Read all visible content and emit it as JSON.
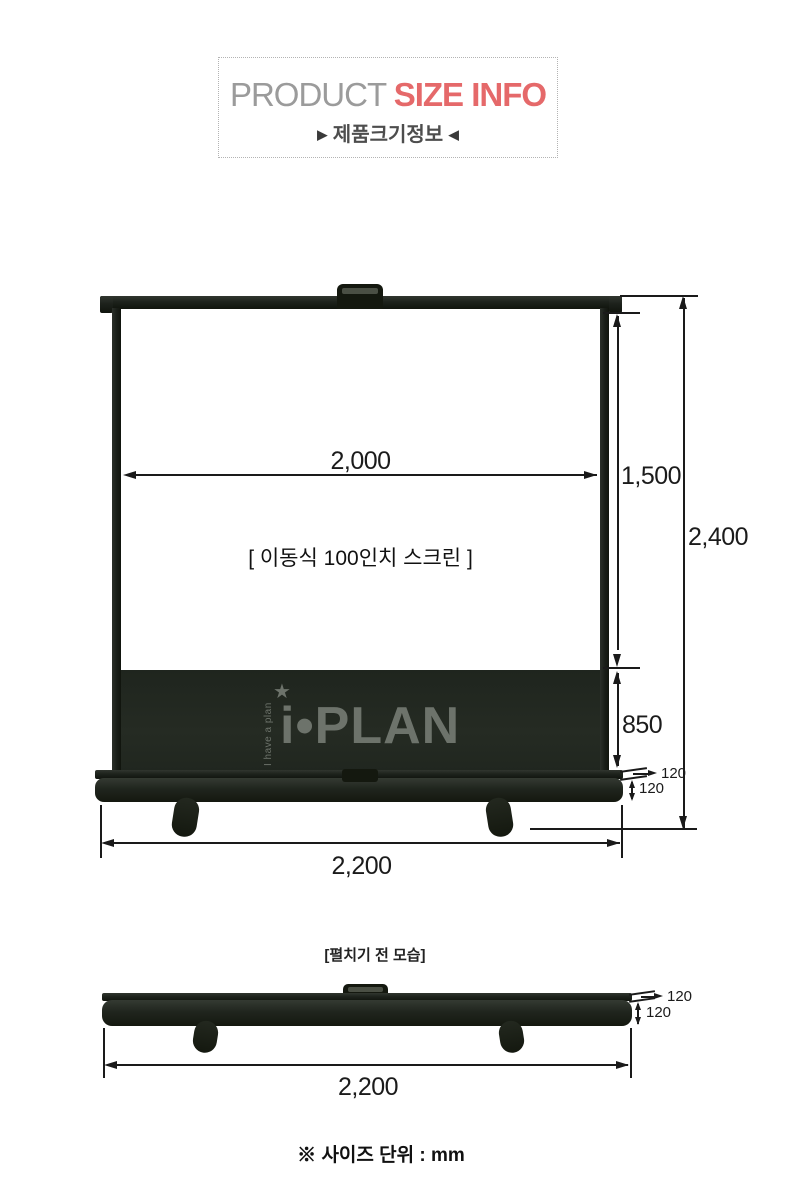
{
  "header": {
    "title_gray": "PRODUCT",
    "title_red": "SIZE INFO",
    "subtitle_left_arrow": "▶",
    "subtitle": "제품크기정보",
    "subtitle_right_arrow": "◀"
  },
  "unfolded": {
    "screen_label": "[ 이동식 100인치 스크린 ]",
    "dim_screen_width": "2,000",
    "dim_screen_height": "1,500",
    "dim_total_height": "2,400",
    "dim_case_height": "850",
    "dim_base_lip": "120",
    "dim_base_body": "120",
    "dim_total_width": "2,200"
  },
  "watermark": {
    "star": "★",
    "tagline": "I have a plan",
    "brand": "i•PLAN"
  },
  "folded": {
    "caption": "[펼치기 전 모습]",
    "dim_base_lip": "120",
    "dim_base_body": "120",
    "dim_total_width": "2,200"
  },
  "footer": {
    "unit_note": "※ 사이즈 단위 : mm"
  },
  "colors": {
    "accent_red": "#e5696a",
    "title_gray": "#9b9b9b",
    "frame_black": "#1d221c",
    "dimension_line": "#1a1a1a",
    "watermark_gray": "#6d736b"
  }
}
